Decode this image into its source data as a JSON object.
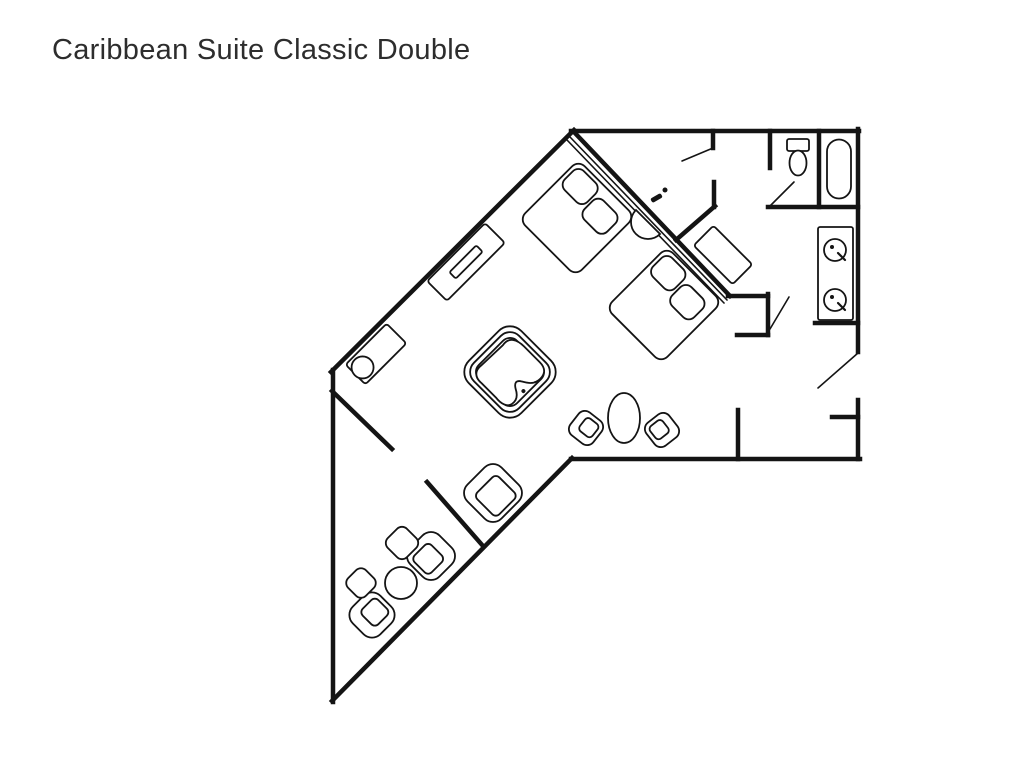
{
  "page": {
    "title": "Caribbean Suite Classic Double",
    "background": "#ffffff",
    "ink": "#141414"
  },
  "floorplan": {
    "stroke_thick": 4.5,
    "stroke_thin": 1.6,
    "stroke_furn": 1.8,
    "walls": [
      {
        "name": "wall-outer-top",
        "pts": [
          571,
          131,
          859,
          131
        ]
      },
      {
        "name": "wall-outer-right-upper",
        "pts": [
          858,
          129,
          858,
          352
        ]
      },
      {
        "name": "wall-outer-right-lower",
        "pts": [
          858,
          400,
          858,
          459
        ]
      },
      {
        "name": "wall-outer-bottom",
        "pts": [
          860,
          459,
          571,
          459
        ]
      },
      {
        "name": "wall-outer-tail-se",
        "pts": [
          572,
          458,
          332,
          701
        ]
      },
      {
        "name": "wall-outer-left",
        "pts": [
          333,
          702,
          333,
          370
        ]
      },
      {
        "name": "wall-outer-nw-diagonal",
        "pts": [
          331,
          372,
          574,
          130
        ]
      },
      {
        "name": "wall-bed-diagonal",
        "pts": [
          574,
          132,
          730,
          296
        ]
      },
      {
        "name": "wall-bed-jog-top",
        "pts": [
          728,
          296,
          768,
          296
        ]
      },
      {
        "name": "wall-bed-jog-right",
        "pts": [
          768,
          294,
          768,
          335
        ]
      },
      {
        "name": "wall-bed-jog-bottom",
        "pts": [
          768,
          335,
          737,
          335
        ]
      },
      {
        "name": "wall-closet-stub",
        "pts": [
          713,
          131,
          713,
          148
        ]
      },
      {
        "name": "wall-hall-stub",
        "pts": [
          714,
          182,
          714,
          207
        ]
      },
      {
        "name": "wall-hall-jog",
        "pts": [
          715,
          206,
          676,
          240
        ]
      },
      {
        "name": "wall-wc-left",
        "pts": [
          770,
          131,
          770,
          168
        ]
      },
      {
        "name": "wall-bath-bottom",
        "pts": [
          768,
          207,
          858,
          207
        ]
      },
      {
        "name": "wall-bath-divider",
        "pts": [
          819,
          131,
          819,
          207
        ]
      },
      {
        "name": "wall-vanity-bottom",
        "pts": [
          815,
          323,
          858,
          323
        ]
      },
      {
        "name": "wall-entry-nook-stub",
        "pts": [
          832,
          417,
          858,
          417
        ]
      },
      {
        "name": "wall-vestibule-left",
        "pts": [
          738,
          410,
          738,
          459
        ]
      },
      {
        "name": "wall-tail-partition-upper",
        "pts": [
          332,
          391,
          392,
          449
        ]
      },
      {
        "name": "wall-tail-partition-lower",
        "pts": [
          427,
          482,
          483,
          546
        ]
      }
    ],
    "thin_lines": [
      {
        "name": "door-swing-closet",
        "pts": [
          713,
          148,
          682,
          161
        ]
      },
      {
        "name": "door-swing-wc",
        "pts": [
          770,
          206,
          794,
          182
        ]
      },
      {
        "name": "door-swing-vanity",
        "pts": [
          770,
          329,
          789,
          297
        ]
      },
      {
        "name": "door-swing-entry",
        "pts": [
          858,
          353,
          818,
          388
        ]
      },
      {
        "name": "headboard-line-1",
        "pts": [
          570,
          137,
          727,
          300
        ]
      },
      {
        "name": "headboard-line-2",
        "pts": [
          567,
          140,
          724,
          303
        ]
      }
    ],
    "furniture": [
      {
        "type": "rect",
        "name": "dresser",
        "cx": 466,
        "cy": 262,
        "w": 82,
        "h": 28,
        "rot": -45,
        "rx": 3,
        "inner": [
          38,
          9,
          0,
          0
        ]
      },
      {
        "type": "rect",
        "name": "wet-bar-counter",
        "cx": 376,
        "cy": 354,
        "w": 58,
        "h": 28,
        "rot": -45,
        "rx": 3,
        "circle": [
          -19,
          0,
          11
        ]
      },
      {
        "type": "jacuzzi",
        "name": "jacuzzi-tub",
        "cx": 510,
        "cy": 372,
        "rot": 45,
        "sizes": [
          74,
          64,
          54
        ],
        "rx": [
          16,
          13,
          10
        ]
      },
      {
        "type": "bed",
        "name": "bed-1",
        "cx": 577,
        "cy": 218,
        "w": 80,
        "h": 84,
        "rot": 45
      },
      {
        "type": "bed",
        "name": "bed-2",
        "cx": 664,
        "cy": 305,
        "w": 78,
        "h": 86,
        "rot": 45
      },
      {
        "type": "halfdisc",
        "name": "nightstand-half-round",
        "cx": 648,
        "cy": 222,
        "r": 17,
        "rot": 45
      },
      {
        "type": "rect",
        "name": "luggage-console",
        "cx": 723,
        "cy": 255,
        "w": 55,
        "h": 28,
        "rot": 45,
        "rx": 3
      },
      {
        "type": "ellipse",
        "name": "oval-table",
        "cx": 624,
        "cy": 418,
        "rx": 16,
        "ry": 25
      },
      {
        "type": "chair",
        "name": "dining-chair-left",
        "cx": 586,
        "cy": 428,
        "s": 29,
        "rot": 38,
        "off": [
          2,
          -2
        ]
      },
      {
        "type": "chair",
        "name": "dining-chair-right",
        "cx": 662,
        "cy": 430,
        "s": 29,
        "rot": -38,
        "off": [
          -2,
          -2
        ]
      },
      {
        "type": "armchair",
        "name": "armchair-hall",
        "cx": 493,
        "cy": 493,
        "s": 48,
        "rot": -45
      },
      {
        "type": "armchair",
        "name": "armchair-lounge-right",
        "cx": 431,
        "cy": 556,
        "s": 41,
        "rot": 45
      },
      {
        "type": "armchair",
        "name": "armchair-lounge-bottom",
        "cx": 372,
        "cy": 615,
        "s": 39,
        "rot": 225
      },
      {
        "type": "rect",
        "name": "ottoman-1",
        "cx": 402,
        "cy": 543,
        "w": 27,
        "h": 27,
        "rot": 45,
        "rx": 7
      },
      {
        "type": "rect",
        "name": "ottoman-2",
        "cx": 361,
        "cy": 583,
        "w": 25,
        "h": 25,
        "rot": 45,
        "rx": 7
      },
      {
        "type": "circle",
        "name": "round-lounge-table",
        "cx": 401,
        "cy": 583,
        "r": 16
      },
      {
        "type": "toilet",
        "name": "toilet",
        "cx": 798,
        "cy": 157,
        "rot": 0
      },
      {
        "type": "rect",
        "name": "bathtub",
        "cx": 839,
        "cy": 169,
        "w": 24,
        "h": 59,
        "rot": 0,
        "rx": 12
      },
      {
        "type": "rect",
        "name": "vanity-counter",
        "cx": 835.5,
        "cy": 273.5,
        "w": 35,
        "h": 93,
        "rot": 0,
        "rx": 2
      },
      {
        "type": "sink",
        "name": "vanity-sink-1",
        "cx": 835,
        "cy": 250,
        "r": 11,
        "rot": 0
      },
      {
        "type": "sink",
        "name": "vanity-sink-2",
        "cx": 835,
        "cy": 300,
        "r": 11,
        "rot": 0
      },
      {
        "type": "dot",
        "name": "fixture-dot",
        "cx": 665,
        "cy": 190,
        "r": 2.5,
        "rot": 0
      },
      {
        "type": "rect",
        "name": "fixture-tick",
        "cx": 656.5,
        "cy": 198,
        "w": 10,
        "h": 3,
        "rot": -30,
        "rx": 1,
        "fill": "ink"
      }
    ]
  }
}
